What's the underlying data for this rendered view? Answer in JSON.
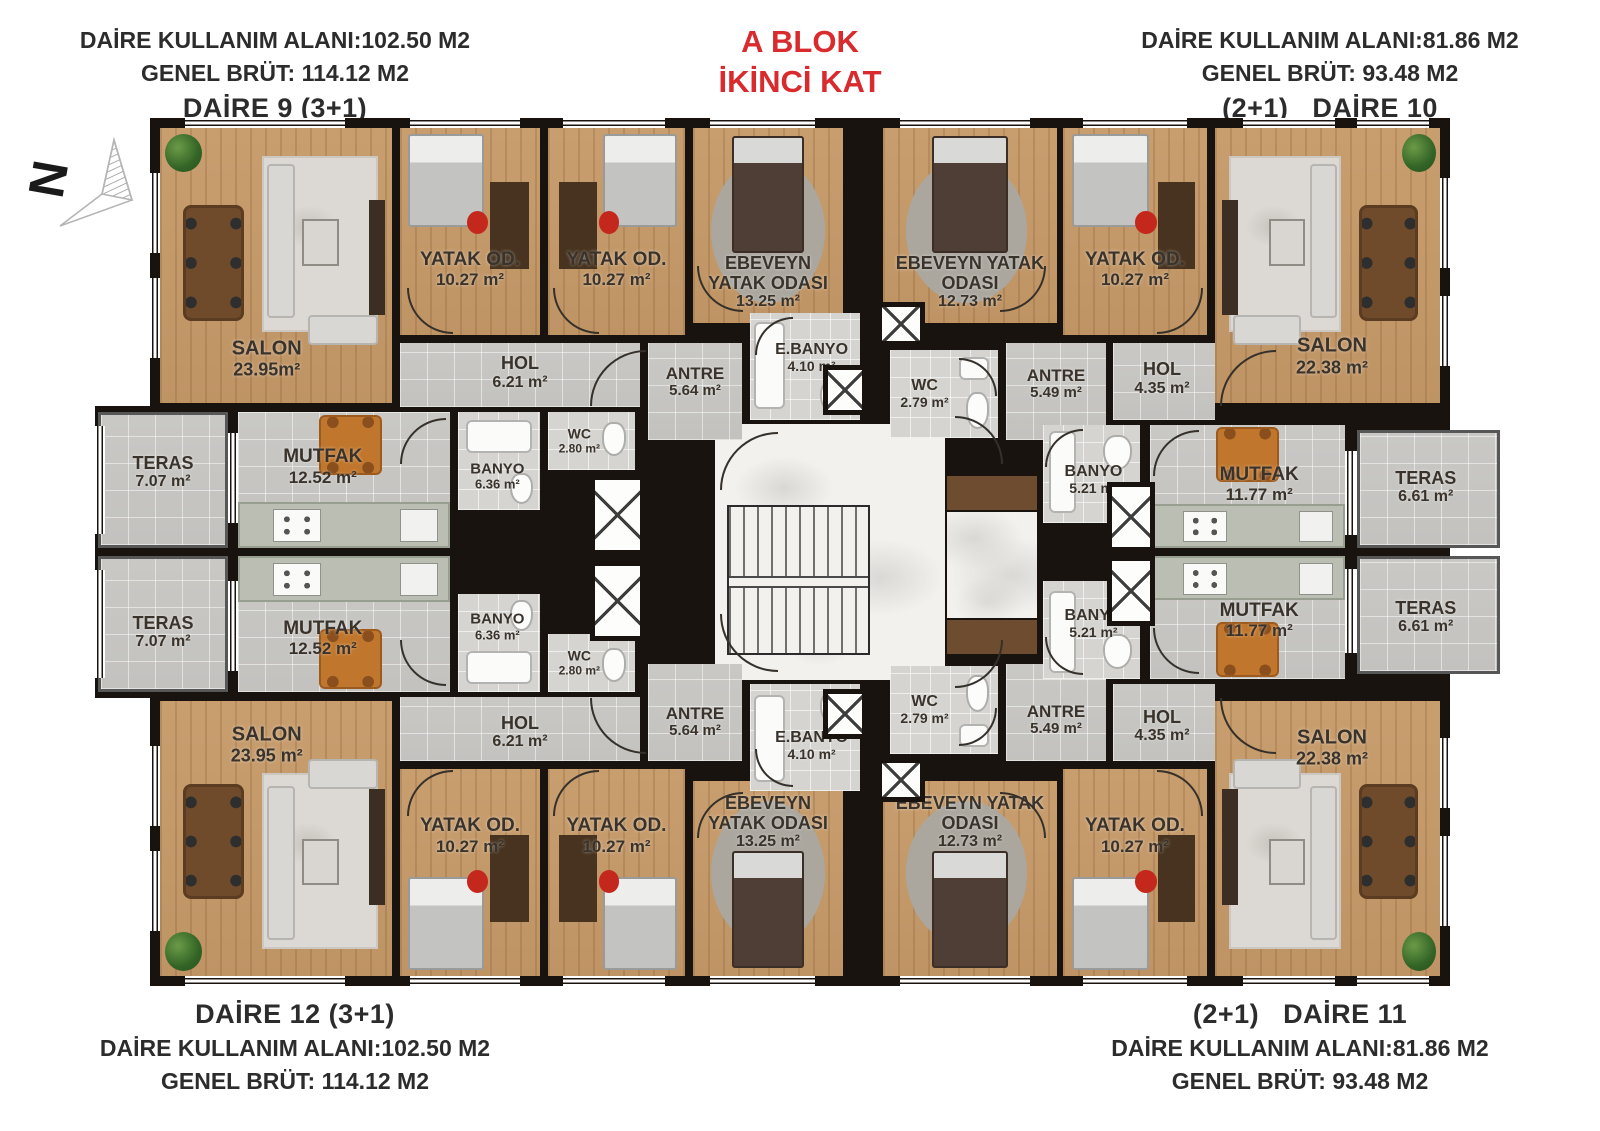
{
  "title": {
    "l1": "A BLOK",
    "l2": "İKİNCİ KAT"
  },
  "north_label": "N",
  "colors": {
    "title_red": "#d92a2e",
    "wall": "#18130f",
    "wood_floor": "#c59a6b",
    "tile_floor": "#c8c7c4"
  },
  "headers": {
    "top_left": {
      "usage": "DAİRE KULLANIM ALANI:102.50 M2",
      "brut": "GENEL BRÜT: 114.12 M2",
      "name": "DAİRE 9 (3+1)"
    },
    "top_right": {
      "usage": "DAİRE KULLANIM ALANI:81.86 M2",
      "brut": "GENEL BRÜT: 93.48 M2",
      "name": "(2+1)   DAİRE 10"
    },
    "bottom_left": {
      "name": "DAİRE 12 (3+1)",
      "usage": "DAİRE KULLANIM ALANI:102.50 M2",
      "brut": "GENEL BRÜT: 114.12 M2"
    },
    "bottom_right": {
      "name": "(2+1)   DAİRE 11",
      "usage": "DAİRE KULLANIM ALANI:81.86 M2",
      "brut": "GENEL BRÜT: 93.48 M2"
    }
  },
  "rooms": {
    "d9": {
      "salon": {
        "name": "SALON",
        "area": "23.95m²"
      },
      "yatak1": {
        "name": "YATAK OD.",
        "area": "10.27 m²"
      },
      "yatak2": {
        "name": "YATAK OD.",
        "area": "10.27 m²"
      },
      "ebeveyn": {
        "name": "EBEVEYN YATAK ODASI",
        "area": "13.25 m²"
      },
      "hol": {
        "name": "HOL",
        "area": "6.21 m²"
      },
      "antre": {
        "name": "ANTRE",
        "area": "5.64 m²"
      },
      "ebanyo": {
        "name": "E.BANYO",
        "area": "4.10 m²"
      },
      "wc": {
        "name": "WC",
        "area": "2.80 m²"
      },
      "banyo": {
        "name": "BANYO",
        "area": "6.36 m²"
      },
      "mutfak": {
        "name": "MUTFAK",
        "area": "12.52 m²"
      },
      "teras": {
        "name": "TERAS",
        "area": "7.07 m²"
      }
    },
    "d10": {
      "ebeveyn": {
        "name": "EBEVEYN YATAK ODASI",
        "area": "12.73 m²"
      },
      "yatak": {
        "name": "YATAK OD.",
        "area": "10.27 m²"
      },
      "salon": {
        "name": "SALON",
        "area": "22.38 m²"
      },
      "hol": {
        "name": "HOL",
        "area": "4.35 m²"
      },
      "antre": {
        "name": "ANTRE",
        "area": "5.49 m²"
      },
      "wc": {
        "name": "WC",
        "area": "2.79 m²"
      },
      "banyo": {
        "name": "BANYO",
        "area": "5.21 m²"
      },
      "mutfak": {
        "name": "MUTFAK",
        "area": "11.77 m²"
      },
      "teras": {
        "name": "TERAS",
        "area": "6.61 m²"
      }
    },
    "d12": {
      "salon": {
        "name": "SALON",
        "area": "23.95 m²"
      },
      "yatak1": {
        "name": "YATAK OD.",
        "area": "10.27 m²"
      },
      "yatak2": {
        "name": "YATAK OD.",
        "area": "10.27 m²"
      },
      "ebeveyn": {
        "name": "EBEVEYN YATAK ODASI",
        "area": "13.25 m²"
      },
      "hol": {
        "name": "HOL",
        "area": "6.21 m²"
      },
      "antre": {
        "name": "ANTRE",
        "area": "5.64 m²"
      },
      "ebanyo": {
        "name": "E.BANYO",
        "area": "4.10 m²"
      },
      "wc": {
        "name": "WC",
        "area": "2.80 m²"
      },
      "banyo": {
        "name": "BANYO",
        "area": "6.36 m²"
      },
      "mutfak": {
        "name": "MUTFAK",
        "area": "12.52 m²"
      },
      "teras": {
        "name": "TERAS",
        "area": "7.07 m²"
      }
    },
    "d11": {
      "ebeveyn": {
        "name": "EBEVEYN YATAK ODASI",
        "area": "12.73 m²"
      },
      "yatak": {
        "name": "YATAK OD.",
        "area": "10.27 m²"
      },
      "salon": {
        "name": "SALON",
        "area": "22.38 m²"
      },
      "hol": {
        "name": "HOL",
        "area": "4.35 m²"
      },
      "antre": {
        "name": "ANTRE",
        "area": "5.49 m²"
      },
      "wc": {
        "name": "WC",
        "area": "2.79 m²"
      },
      "banyo": {
        "name": "BANYO",
        "area": "5.21 m²"
      },
      "mutfak": {
        "name": "MUTFAK",
        "area": "11.77 m²"
      },
      "teras": {
        "name": "TERAS",
        "area": "6.61 m²"
      }
    }
  }
}
